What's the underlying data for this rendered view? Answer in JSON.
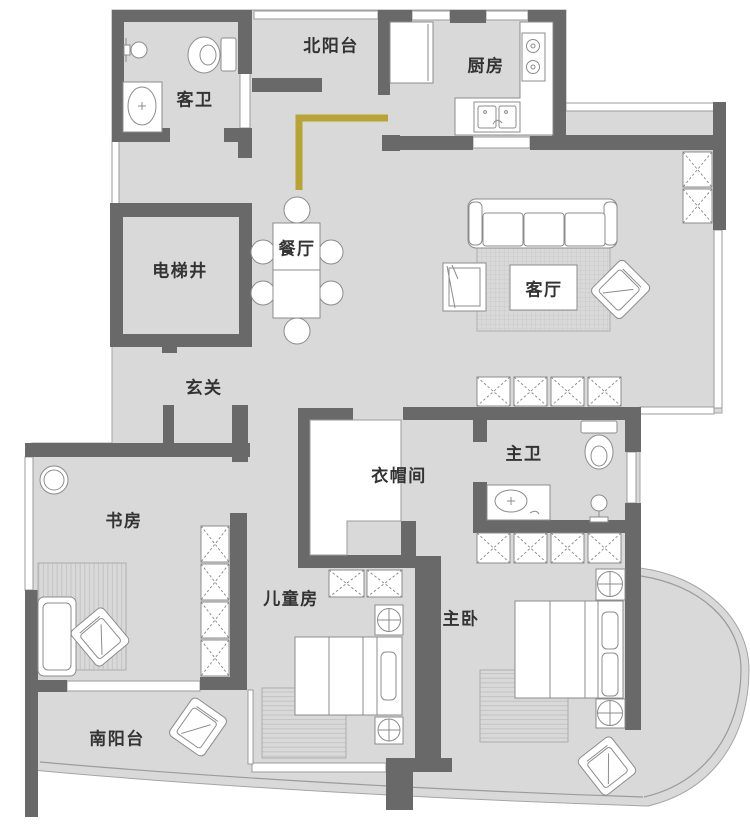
{
  "meta": {
    "title": "apartment-floor-plan",
    "canvas": {
      "width": 750,
      "height": 824
    }
  },
  "palette": {
    "wall": "#696969",
    "floor": "#d9d9d9",
    "boundary_line": "#9b9b9b",
    "furniture_stroke": "#8c8c8c",
    "renovation_marker": "#b7a434",
    "label_color": "#333333"
  },
  "rooms": [
    {
      "id": "north-balcony",
      "label": "北阳台"
    },
    {
      "id": "kitchen",
      "label": "厨房"
    },
    {
      "id": "guest-bathroom",
      "label": "客卫"
    },
    {
      "id": "dining-room",
      "label": "餐厅"
    },
    {
      "id": "living-room",
      "label": "客厅"
    },
    {
      "id": "elevator-shaft",
      "label": "电梯井"
    },
    {
      "id": "foyer",
      "label": "玄关"
    },
    {
      "id": "cloakroom",
      "label": "衣帽间"
    },
    {
      "id": "master-bathroom",
      "label": "主卫"
    },
    {
      "id": "study",
      "label": "书房"
    },
    {
      "id": "children-room",
      "label": "儿童房"
    },
    {
      "id": "master-bedroom",
      "label": "主卧"
    },
    {
      "id": "south-balcony",
      "label": "南阳台"
    }
  ],
  "furniture_icons": {
    "guest_bathroom": [
      "toilet",
      "vanity-sink",
      "wall-faucet"
    ],
    "kitchen": [
      "fridge",
      "l-counter",
      "two-burner-stove",
      "double-basin-sink"
    ],
    "dining_room": [
      "two-part-table",
      "six-chairs"
    ],
    "living_room": [
      "three-seat-sofa",
      "grid-rug",
      "armchair",
      "rotated-armchair",
      "four-x-cabinets",
      "entry-x-cabinets"
    ],
    "cloakroom": [
      "l-shaped-closet"
    ],
    "master_bathroom": [
      "toilet",
      "vanity-sink",
      "shower-head"
    ],
    "study": [
      "hanging-chair",
      "striped-rug",
      "daybed",
      "rotated-armchair",
      "bookshelf-x-column"
    ],
    "children_room": [
      "two-x-cabinets",
      "circle-cross-nightstands",
      "single-bed",
      "striped-rug"
    ],
    "master_bedroom": [
      "four-x-wardrobe",
      "circle-cross-nightstands",
      "double-bed",
      "striped-rug",
      "balcony-armchair"
    ],
    "south_balcony": [
      "rotated-armchair"
    ]
  },
  "renovation_marker": {
    "shape": "L-line",
    "color": "#b7a434"
  }
}
